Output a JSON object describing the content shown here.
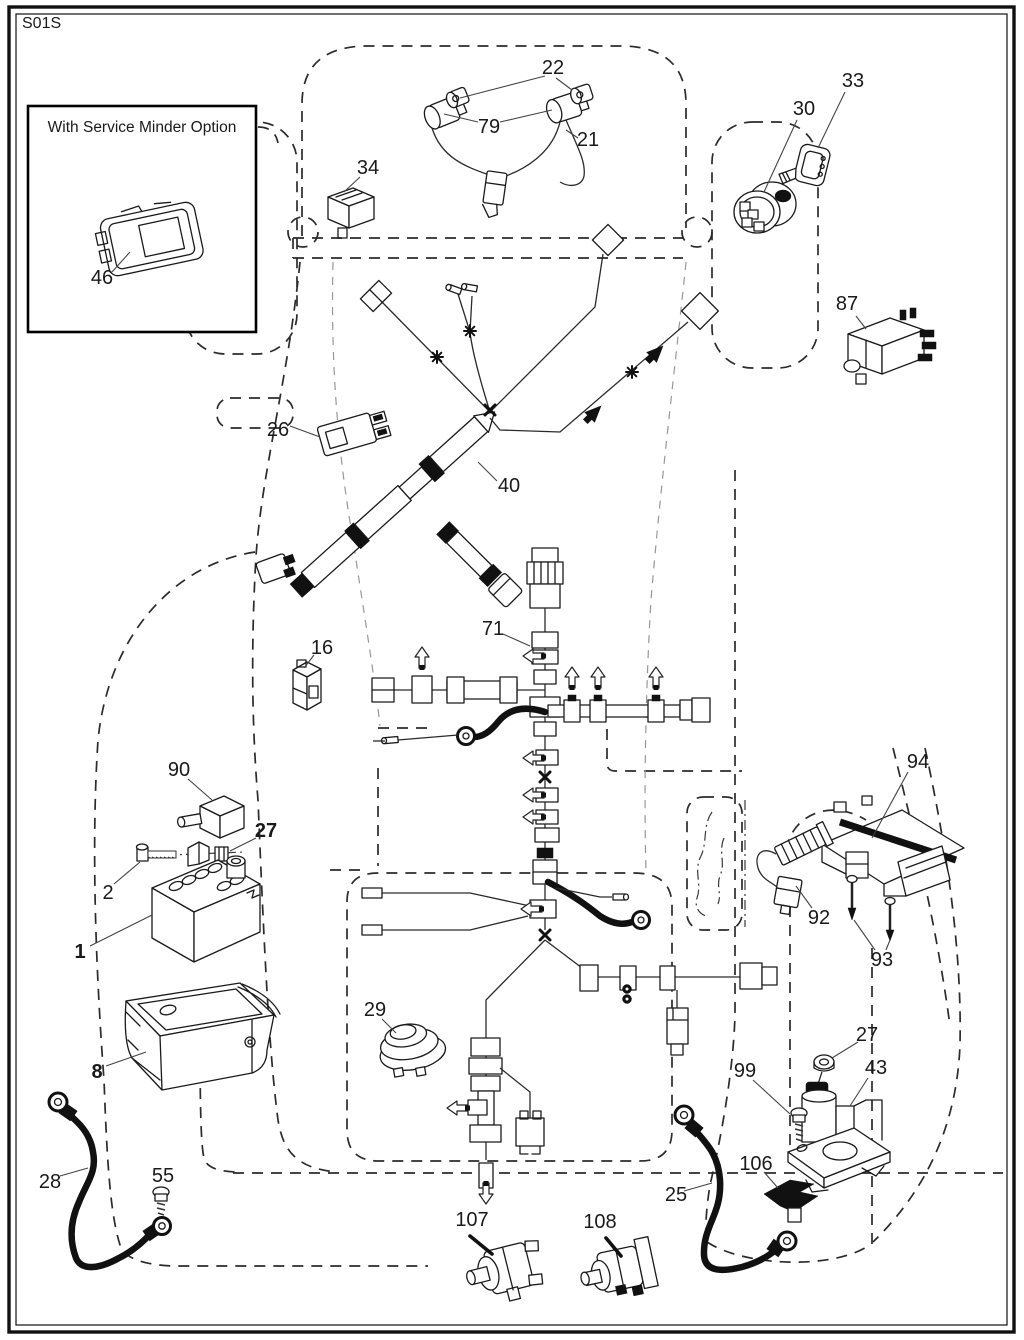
{
  "page": {
    "diagram_code": "S01S"
  },
  "inset": {
    "title": "With Service Minder Option"
  },
  "parts": {
    "p1": "1",
    "p2": "2",
    "p8": "8",
    "p16": "16",
    "p21": "21",
    "p22": "22",
    "p25": "25",
    "p26": "26",
    "p27": "27",
    "p28": "28",
    "p29": "29",
    "p30": "30",
    "p33": "33",
    "p34": "34",
    "p40": "40",
    "p43": "43",
    "p46": "46",
    "p55": "55",
    "p71": "71",
    "p79": "79",
    "p87": "87",
    "p90": "90",
    "p92": "92",
    "p93": "93",
    "p94": "94",
    "p99": "99",
    "p106": "106",
    "p107": "107",
    "p108": "108"
  }
}
